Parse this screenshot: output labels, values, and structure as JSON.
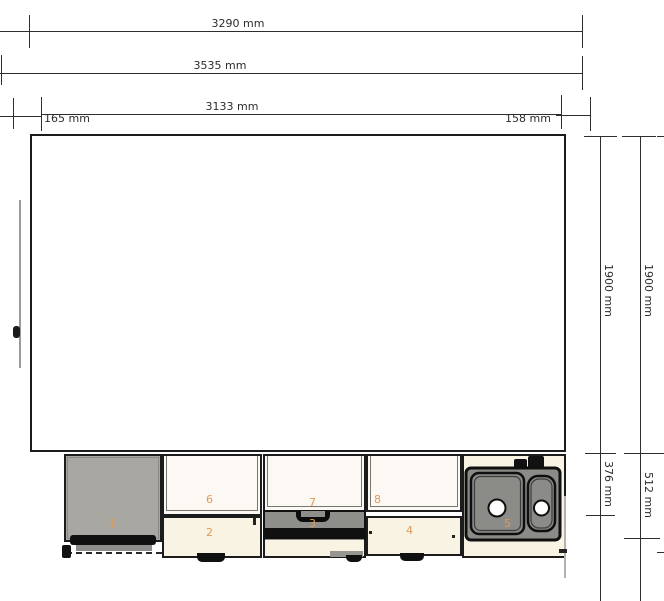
{
  "dims": {
    "top": {
      "d3290": "3290 mm",
      "d3535": "3535 mm",
      "d3133": "3133 mm",
      "d165": "165 mm",
      "d158": "158 mm"
    },
    "right": {
      "d1900a": "1900 mm",
      "d1900b": "1900 mm",
      "d376": "376 mm",
      "d512": "512 mm"
    }
  },
  "items": {
    "i1": "1",
    "i2": "2",
    "i3": "3",
    "i4": "4",
    "i5": "5",
    "i6": "6",
    "i7": "7",
    "i8": "8"
  },
  "colors": {
    "dimension_line": "#2e2e2e",
    "outline": "#1c1c1c",
    "wall_cabinet_fill": "#fcf9f4",
    "base_cabinet_fill": "#f8f3e2",
    "appliance_fill": "#a8a7a2",
    "oven_front_fill": "#8e8e8b",
    "sink_fill": "#8b8b88",
    "item_number_orange": "#e39a55"
  }
}
